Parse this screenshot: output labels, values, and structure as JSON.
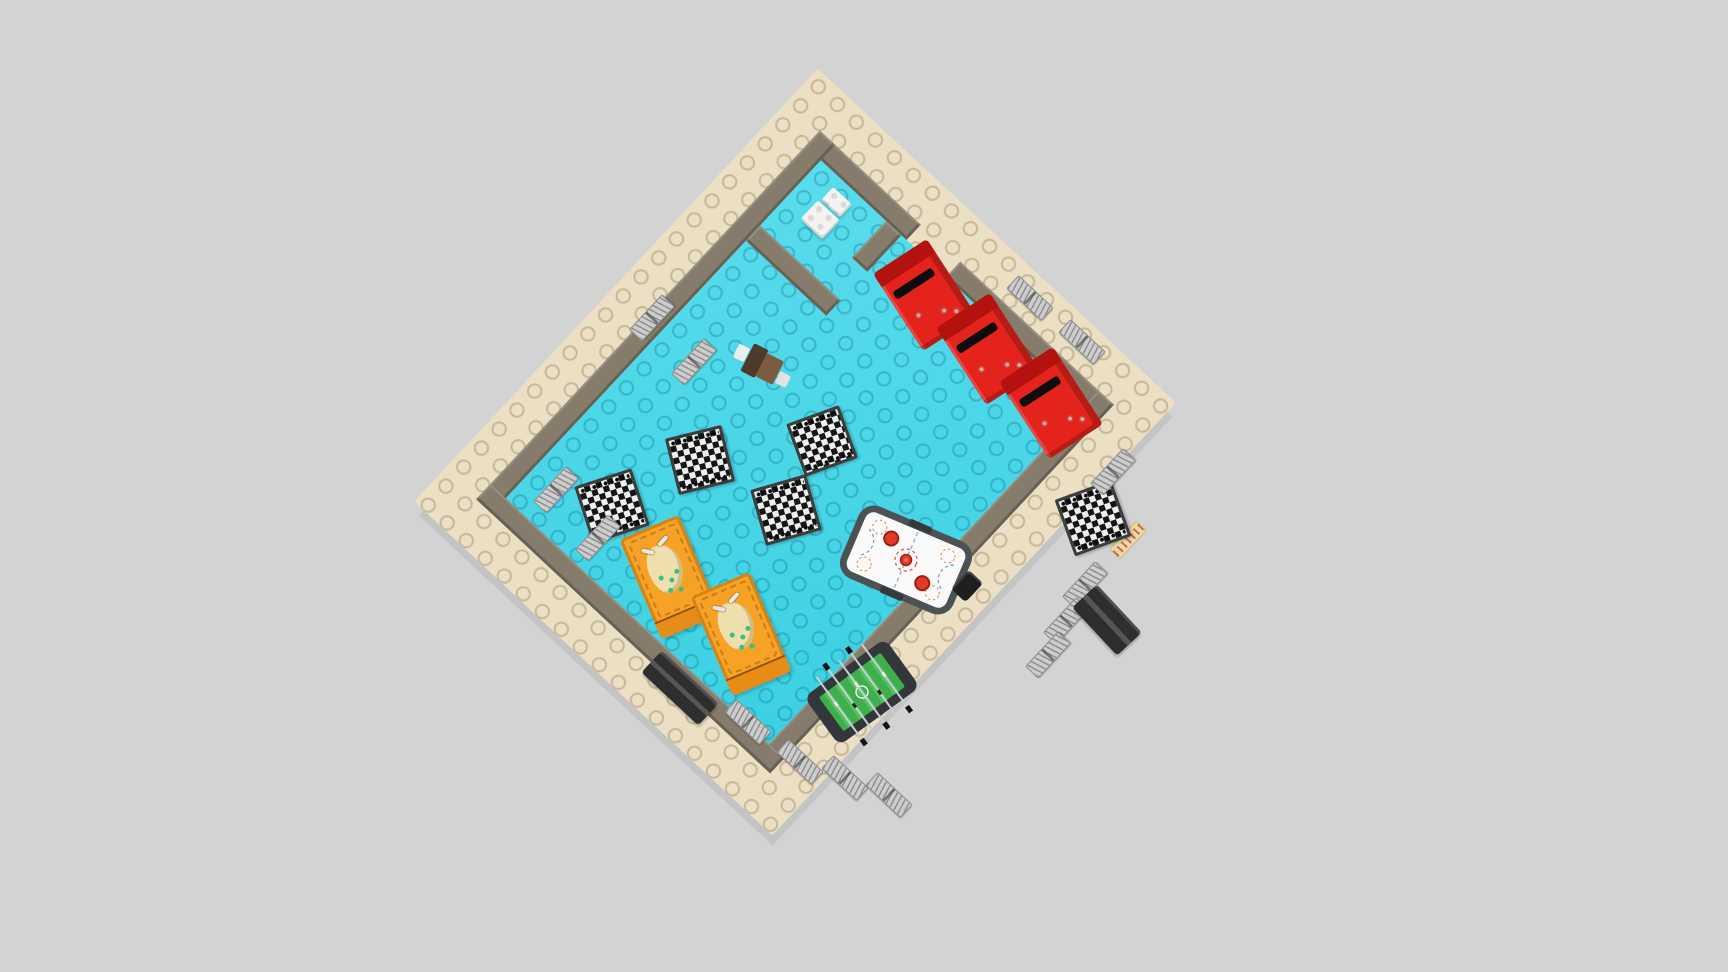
{
  "scene": {
    "background": "#d3d3d3",
    "view": "top-down 3D render of a LEGO arcade game-room model"
  },
  "colors": {
    "plate": "#ebdfc4",
    "plate_stud": "rgba(120,96,56,0.30)",
    "wall": "#857c6c",
    "floor": "#3ed7e9",
    "floor_stud": "rgba(0,105,130,0.30)",
    "arcade_red": "#e4231c",
    "arcade_dark": "#b3120e",
    "pinball_orange": "#f5a226",
    "table_white": "#fafafa",
    "rim": "#4c5154",
    "field_green": "#3fae4d",
    "bench": "#2e2e2e",
    "panel": "#cdcdcd",
    "toilet": "#f4f3f0",
    "chair_brown": "#7b5b41",
    "chair_dark": "#4e3a29"
  },
  "plate": {
    "cx": 795,
    "cy": 452,
    "w": 490,
    "h": 592,
    "rot": 43,
    "parts": [
      {
        "cls": "wall",
        "name": "outer-wall-top-right-a",
        "x": 44,
        "y": 44,
        "w": 138,
        "h": 21
      },
      {
        "cls": "wall",
        "name": "outer-wall-top-right-b",
        "x": 236,
        "y": 44,
        "w": 210,
        "h": 21
      },
      {
        "cls": "wall",
        "name": "outer-wall-left",
        "x": 44,
        "y": 44,
        "w": 21,
        "h": 504
      },
      {
        "cls": "wall",
        "name": "outer-wall-right",
        "x": 425,
        "y": 44,
        "w": 21,
        "h": 504
      },
      {
        "cls": "wall",
        "name": "outer-wall-bottom",
        "x": 44,
        "y": 527,
        "w": 402,
        "h": 21
      },
      {
        "cls": "floor",
        "name": "room-floor",
        "x": 65,
        "y": 65,
        "w": 360,
        "h": 462
      },
      {
        "cls": "wall",
        "name": "closet-wall-right",
        "x": 154,
        "y": 65,
        "w": 21,
        "h": 50
      },
      {
        "cls": "wall",
        "name": "closet-wall-bottom",
        "x": 65,
        "y": 154,
        "w": 110,
        "h": 21
      },
      {
        "cls": "toilet-tank",
        "name": "toilet-tank",
        "x": 92,
        "y": 76,
        "w": 26,
        "h": 18
      },
      {
        "cls": "toilet-bowl",
        "name": "toilet-bowl",
        "x": 90,
        "y": 96,
        "w": 30,
        "h": 26
      }
    ]
  },
  "furniture": {
    "arcade_machines": [
      {
        "cx": 925,
        "cy": 295,
        "w": 64,
        "h": 92,
        "rot": -33
      },
      {
        "cx": 988,
        "cy": 349,
        "w": 64,
        "h": 92,
        "rot": -33
      },
      {
        "cx": 1051,
        "cy": 403,
        "w": 64,
        "h": 92,
        "rot": -33
      }
    ],
    "chessboards": [
      {
        "cx": 612,
        "cy": 506,
        "w": 54,
        "h": 54,
        "rot": -18
      },
      {
        "cx": 700,
        "cy": 460,
        "w": 52,
        "h": 52,
        "rot": -14
      },
      {
        "cx": 822,
        "cy": 441,
        "w": 50,
        "h": 50,
        "rot": -20
      },
      {
        "cx": 786,
        "cy": 510,
        "w": 52,
        "h": 52,
        "rot": -16
      },
      {
        "cx": 1093,
        "cy": 518,
        "w": 54,
        "h": 54,
        "rot": -20
      }
    ],
    "pinball_machines": [
      {
        "cx": 670,
        "cy": 577,
        "w": 64,
        "h": 108,
        "rot": -23
      },
      {
        "cx": 741,
        "cy": 634,
        "w": 64,
        "h": 108,
        "rot": -23
      }
    ],
    "air_hockey": {
      "cx": 906,
      "cy": 560,
      "w": 124,
      "h": 80,
      "rot": 23
    },
    "foosball": {
      "cx": 862,
      "cy": 692,
      "w": 104,
      "h": 64,
      "rot": -36
    },
    "chair": {
      "cx": 764,
      "cy": 366,
      "w": 64,
      "h": 36,
      "rot": 27
    },
    "trash_bin": {
      "cx": 967,
      "cy": 586,
      "w": 20,
      "h": 26,
      "rot": 43
    },
    "sign": {
      "cx": 1128,
      "cy": 540,
      "w": 13,
      "h": 38,
      "rot": 43
    },
    "benches": [
      {
        "cx": 680,
        "cy": 688,
        "w": 78,
        "h": 30,
        "rot": 43
      },
      {
        "cx": 1107,
        "cy": 620,
        "w": 66,
        "h": 34,
        "rot": 47
      }
    ],
    "wall_posters": [
      {
        "cx": 652,
        "cy": 318,
        "rot": -47
      },
      {
        "cx": 694,
        "cy": 362,
        "rot": -47
      },
      {
        "cx": 556,
        "cy": 490,
        "rot": -47
      },
      {
        "cx": 598,
        "cy": 538,
        "rot": -47
      },
      {
        "cx": 1030,
        "cy": 298,
        "rot": 43
      },
      {
        "cx": 1082,
        "cy": 342,
        "rot": 43
      },
      {
        "cx": 1113,
        "cy": 472,
        "rot": -47
      },
      {
        "cx": 1085,
        "cy": 585,
        "rot": -47
      },
      {
        "cx": 1066,
        "cy": 621,
        "rot": -47
      },
      {
        "cx": 1048,
        "cy": 655,
        "rot": -47
      },
      {
        "cx": 800,
        "cy": 762,
        "rot": 43
      },
      {
        "cx": 845,
        "cy": 778,
        "rot": 43
      },
      {
        "cx": 889,
        "cy": 795,
        "rot": 43
      },
      {
        "cx": 748,
        "cy": 722,
        "rot": 43
      }
    ]
  }
}
